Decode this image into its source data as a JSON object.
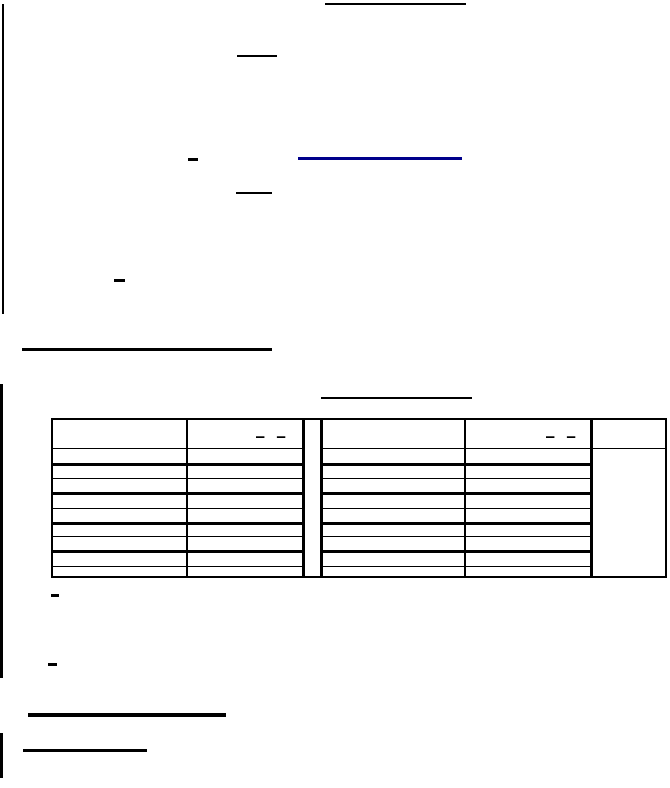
{
  "page": {
    "background": "#ffffff"
  },
  "colors": {
    "ink": "#000000",
    "link_underline_blue": "#00008b"
  },
  "marks": {
    "standalone_hyphen": "-",
    "standalone_hyphen_count": 4
  },
  "table": {
    "column_count": 5,
    "has_gap_column": true,
    "body_row_count": 9,
    "header_mark_left": "– –",
    "header_mark_right": "– –"
  }
}
